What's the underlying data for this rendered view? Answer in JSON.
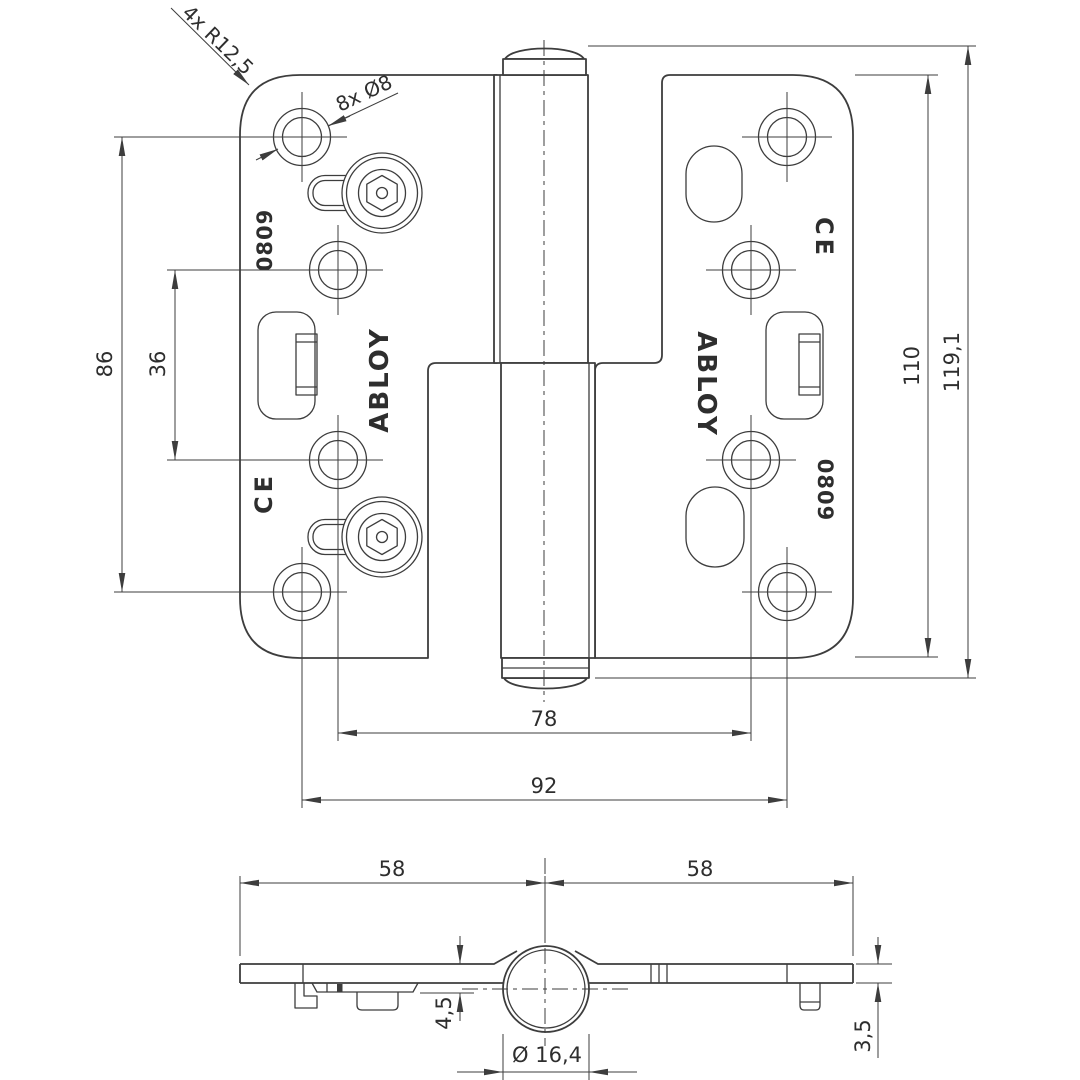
{
  "labels": {
    "corner_radius": "4x R12,5",
    "hole_spec": "8x Ø8",
    "brand": "ABLOY",
    "model": "0809",
    "ce_mark": "CE"
  },
  "dimensions": {
    "hole_rows_outer": "86",
    "hole_rows_inner": "36",
    "leaf_height": "110",
    "overall_height": "119,1",
    "hole_cols_inner": "78",
    "hole_cols_outer": "92",
    "left_half_width": "58",
    "right_half_width": "58",
    "pin_center_offset": "4,5",
    "leaf_thickness": "3,5",
    "knuckle_diameter": "Ø 16,4"
  },
  "colors": {
    "line": "#3d3d3d",
    "text": "#2e2e2e",
    "background": "#ffffff"
  }
}
